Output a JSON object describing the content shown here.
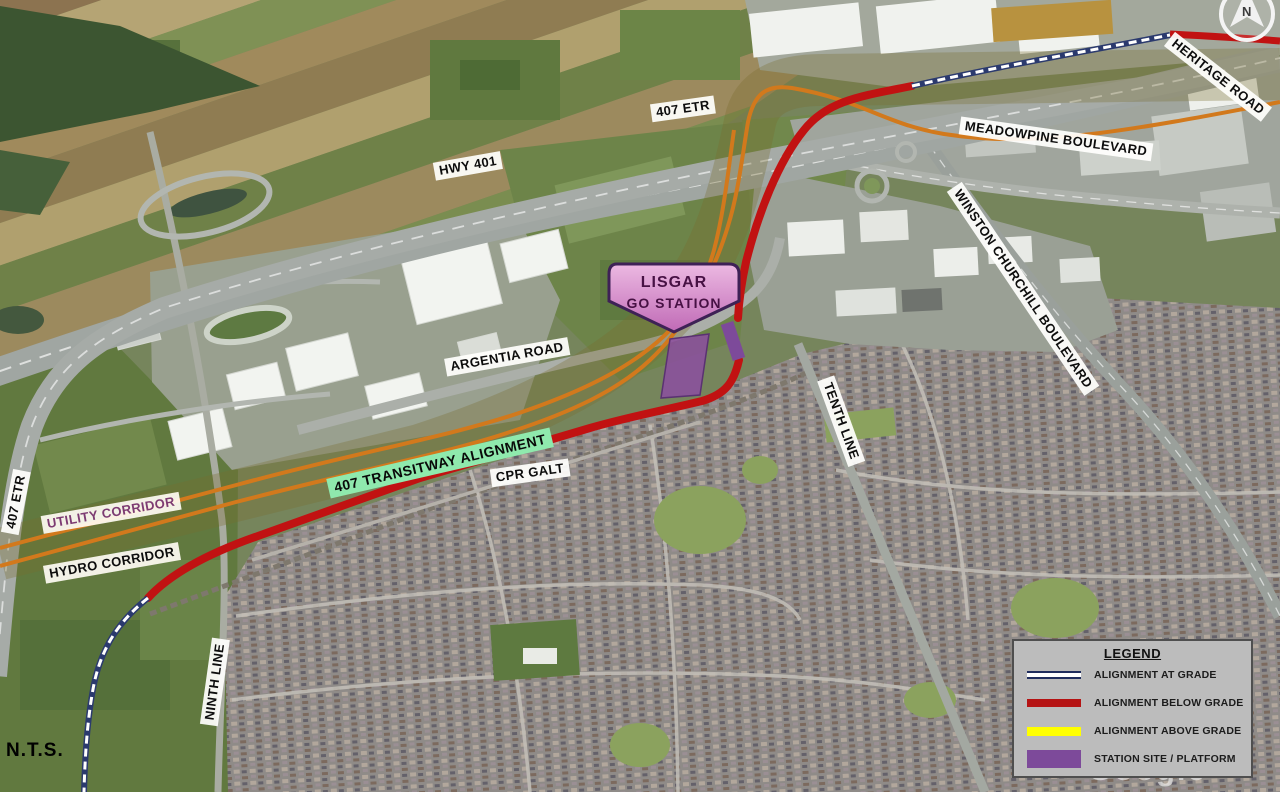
{
  "title": "407 Transitway alignment map - Lisgar GO Station area",
  "map": {
    "scale_note": "N.T.S.",
    "watermark": "Google",
    "compass_letter": "N",
    "station_callout": {
      "line1": "LISGAR",
      "line2": "GO STATION"
    },
    "labels": {
      "hwy401": {
        "text": "HWY 401"
      },
      "etr407_top": {
        "text": "407 ETR"
      },
      "etr407_left": {
        "text": "407 ETR"
      },
      "meadowpine": {
        "text": "MEADOWPINE BOULEVARD"
      },
      "heritage_road": {
        "text": "HERITAGE ROAD"
      },
      "winston_churchill": {
        "text": "WINSTON CHURCHILL BOULEVARD"
      },
      "tenth_line": {
        "text": "TENTH LINE"
      },
      "ninth_line": {
        "text": "NINTH LINE"
      },
      "argentia_road": {
        "text": "ARGENTIA ROAD"
      },
      "cpr_galt": {
        "text": "CPR GALT"
      },
      "transitway": {
        "text": "407 TRANSITWAY ALIGNMENT"
      },
      "utility_corridor": {
        "text": "UTILITY CORRIDOR"
      },
      "hydro_corridor": {
        "text": "HYDRO CORRIDOR"
      }
    },
    "colors": {
      "alignment_at_grade": "#2b3a6e",
      "alignment_below_grade": "#c11212",
      "alignment_above_grade": "#ffff00",
      "station_site": "#7d4a9a",
      "corridor_line": "#d2791c",
      "transitway_label_bg": "#8fe9ad"
    }
  },
  "legend": {
    "title": "LEGEND",
    "items": [
      {
        "id": "at-grade",
        "label": "ALIGNMENT AT GRADE"
      },
      {
        "id": "below-grade",
        "label": "ALIGNMENT BELOW GRADE"
      },
      {
        "id": "above-grade",
        "label": "ALIGNMENT ABOVE GRADE"
      },
      {
        "id": "station-site",
        "label": "STATION SITE / PLATFORM"
      }
    ]
  }
}
